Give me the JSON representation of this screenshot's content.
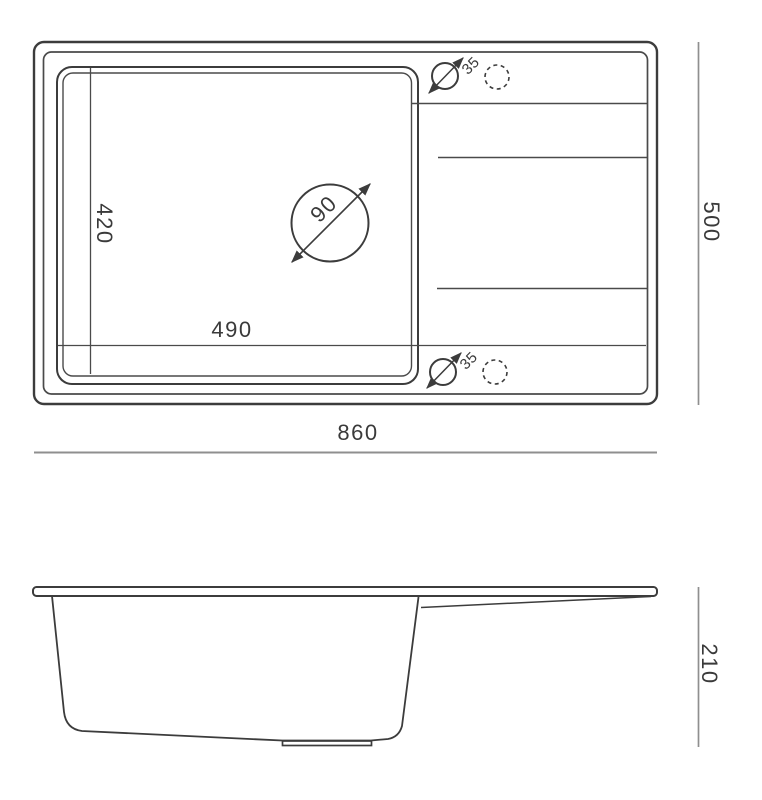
{
  "drawing": {
    "background": "#ffffff",
    "line_color": "#3c3c3c",
    "thin_line_color": "#4a4a4a",
    "dimension_line_color": "#8f8f8f",
    "text_color": "#3a3a3a",
    "top_view": {
      "overall_width": "860",
      "overall_depth": "500",
      "bowl_width": "490",
      "bowl_depth": "420",
      "drain_hole_diameter": "90",
      "tap_hole_diameter_top": "35",
      "tap_hole_diameter_bottom": "35"
    },
    "side_view": {
      "overall_height": "210"
    }
  }
}
